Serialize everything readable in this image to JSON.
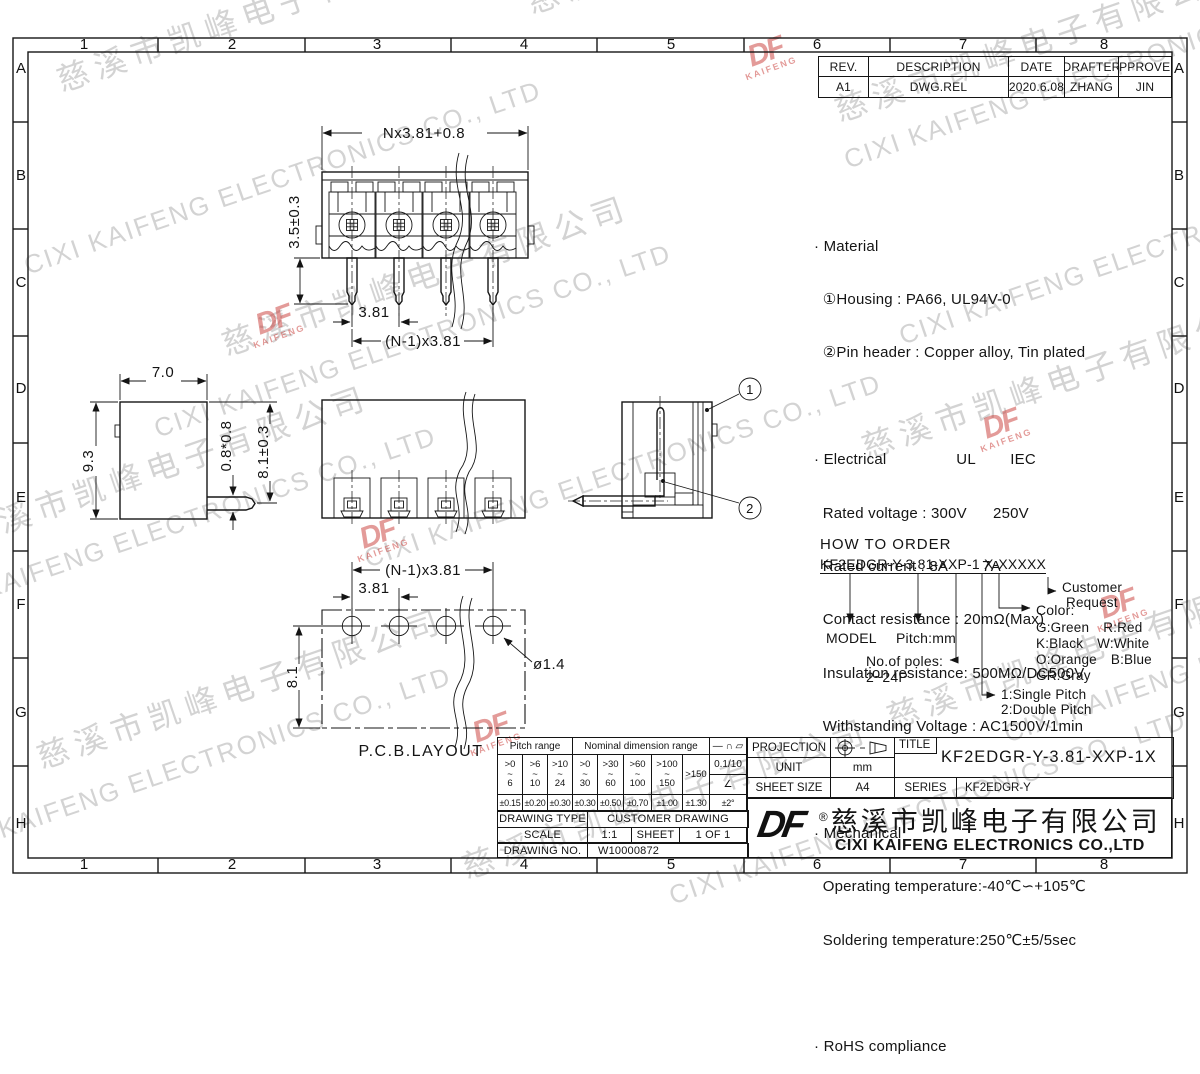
{
  "frame": {
    "cols": [
      "1",
      "2",
      "3",
      "4",
      "5",
      "6",
      "7",
      "8"
    ],
    "rows": [
      "A",
      "B",
      "C",
      "D",
      "E",
      "F",
      "G",
      "H"
    ]
  },
  "revision": {
    "headers": {
      "rev": "REV.",
      "description": "DESCRIPTION",
      "date": "DATE",
      "drafter": "DRAFTER",
      "approver": "APPROVER"
    },
    "entry": {
      "rev": "A1",
      "description": "DWG.REL",
      "date": "2020.6.08",
      "drafter": "ZHANG",
      "approver": "JIN"
    }
  },
  "notes": {
    "lines": [
      "· Material",
      "  ①Housing : PA66, UL94V-0",
      "  ②Pin header : Copper alloy, Tin plated",
      "",
      "· Electrical                UL        IEC",
      "  Rated voltage : 300V      250V",
      "  Rated current : 8A        7A",
      "  Contact resistance : 20mΩ(Max)",
      "  Insulation resistance: 500MΩ/DC500V",
      "  Withstanding Voltage : AC1500V/1min",
      "",
      "· Mechanical",
      "  Operating temperature:-40℃∽+105℃",
      "  Soldering temperature:250℃±5/5sec",
      "",
      "· RoHS compliance"
    ]
  },
  "order": {
    "title": "HOW TO ORDER",
    "code": "KF2EDGR-Y-3.81-XXP-1 X-XXXXX",
    "model_label": "MODEL",
    "pitch_label": "Pitch:mm",
    "poles_label": "No.of poles:",
    "poles_value": "2~24P",
    "pitch_type_1": "1:Single Pitch",
    "pitch_type_2": "2:Double Pitch",
    "color_label": "Color:",
    "colors": [
      "G:Green",
      "R:Red",
      "K:Black",
      "W:White",
      "O:Orange",
      "B:Blue",
      "GR:Gray"
    ],
    "customer_1": "Customer",
    "customer_2": "Request"
  },
  "dims": {
    "front_width": "Nx3.81+0.8",
    "front_pin_len": "3.5±0.3",
    "front_pitch": "3.81",
    "front_span": "(N-1)x3.81",
    "side_width": "7.0",
    "side_height": "9.3",
    "side_pin": "0.8*0.8",
    "side_pin_h": "8.1±0.3",
    "pcb_span": "(N-1)x3.81",
    "pcb_pitch": "3.81",
    "pcb_hole": "ø1.4",
    "pcb_height": "8.1",
    "pcb_caption": "P.C.B.LAYOUT",
    "callout_1": "1",
    "callout_2": "2"
  },
  "tolerance": {
    "pitch_header": "Pitch range",
    "nominal_header": "Nominal dimension range",
    "symbols_header": "— ∩ ▱",
    "ranges": [
      ">0\n~\n6",
      ">6\n~\n10",
      ">10\n~\n24",
      ">0\n~\n30",
      ">30\n~\n60",
      ">60\n~\n100",
      ">100\n~\n150",
      ">150"
    ],
    "values": [
      "±0.15",
      "±0.20",
      "±0.30",
      "±0.30",
      "±0.50",
      "±0.70",
      "±1.00",
      "±1.30"
    ],
    "flatness": "0.1/10",
    "angle_symbol": "∠",
    "angle_tol": "±2°"
  },
  "titleblock": {
    "projection_label": "PROJECTION",
    "unit_label": "UNIT",
    "unit_value": "mm",
    "sheet_size_label": "SHEET SIZE",
    "sheet_size_value": "A4",
    "title_label": "TITLE",
    "title_value": "KF2EDGR-Y-3.81-XXP-1X",
    "series_label": "SERIES",
    "series_value": "KF2EDGR-Y",
    "drawing_type_label": "DRAWING TYPE",
    "drawing_type_value": "CUSTOMER DRAWING",
    "scale_label": "SCALE",
    "scale_value": "1:1",
    "sheet_label": "SHEET",
    "sheet_value": "1 OF 1",
    "drawing_no_label": "DRAWING NO.",
    "drawing_no_value": "W10000872"
  },
  "company": {
    "logo": "DF",
    "reg": "®",
    "name_cn": "慈溪市凯峰电子有限公司",
    "name_en": "CIXI KAIFENG ELECTRONICS CO.,LTD"
  },
  "watermark": {
    "cn": "慈溪市凯峰电子有限公司",
    "en": "CIXI KAIFENG ELECTRONICS CO., LTD",
    "logo_top": "DF",
    "logo_bottom": "KAIFENG"
  }
}
